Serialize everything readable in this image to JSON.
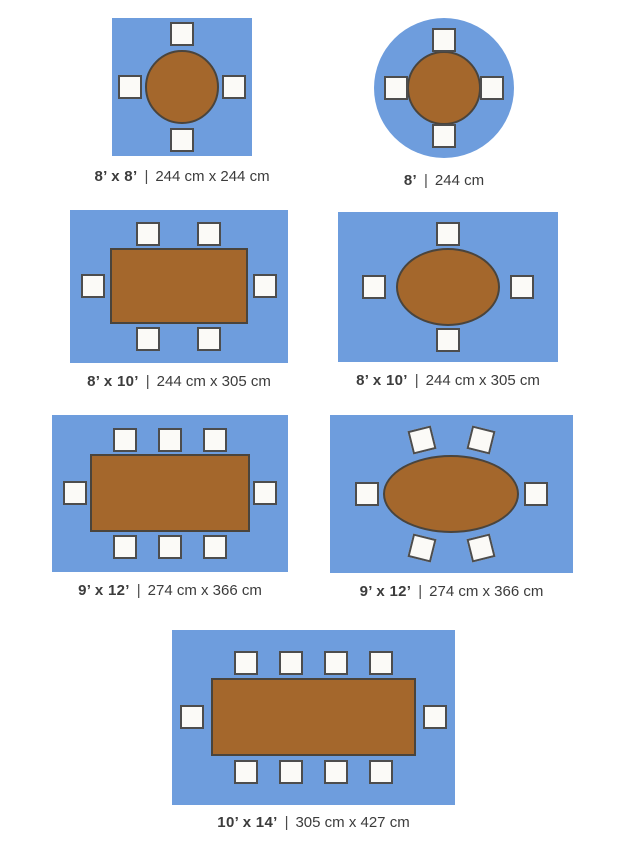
{
  "separator": "|",
  "colors": {
    "rug_blue": "#6E9DDD",
    "table_brown": "#A4672C",
    "table_border": "#4A443C",
    "chair_fill": "#FBFAF7",
    "chair_border": "#4D4D4D",
    "label_text": "#3C3C3C",
    "background": "#FFFFFF"
  },
  "figures": [
    {
      "id": "square-rug-8x8",
      "rug_shape": "square",
      "table_shape": "round",
      "seats": 4,
      "size_ft": "8’ x 8’",
      "size_cm": "244 cm x 244 cm"
    },
    {
      "id": "round-rug-8",
      "rug_shape": "round",
      "table_shape": "round",
      "seats": 4,
      "size_ft": "8’",
      "size_cm": "244 cm"
    },
    {
      "id": "rect-rug-8x10-rect-table",
      "rug_shape": "rectangle",
      "table_shape": "rectangle",
      "seats": 6,
      "size_ft": "8’ x 10’",
      "size_cm": "244 cm x 305 cm"
    },
    {
      "id": "rect-rug-8x10-oval-table",
      "rug_shape": "rectangle",
      "table_shape": "oval",
      "seats": 4,
      "size_ft": "8’ x 10’",
      "size_cm": "244 cm x 305 cm"
    },
    {
      "id": "rect-rug-9x12-rect-table",
      "rug_shape": "rectangle",
      "table_shape": "rectangle",
      "seats": 8,
      "size_ft": "9’ x 12’",
      "size_cm": "274 cm x 366 cm"
    },
    {
      "id": "rect-rug-9x12-oval-table",
      "rug_shape": "rectangle",
      "table_shape": "oval",
      "seats": 6,
      "size_ft": "9’ x 12’",
      "size_cm": "274 cm x 366 cm"
    },
    {
      "id": "rect-rug-10x14-rect-table",
      "rug_shape": "rectangle",
      "table_shape": "rectangle",
      "seats": 10,
      "size_ft": "10’ x 14’",
      "size_cm": "305 cm x 427 cm"
    }
  ]
}
